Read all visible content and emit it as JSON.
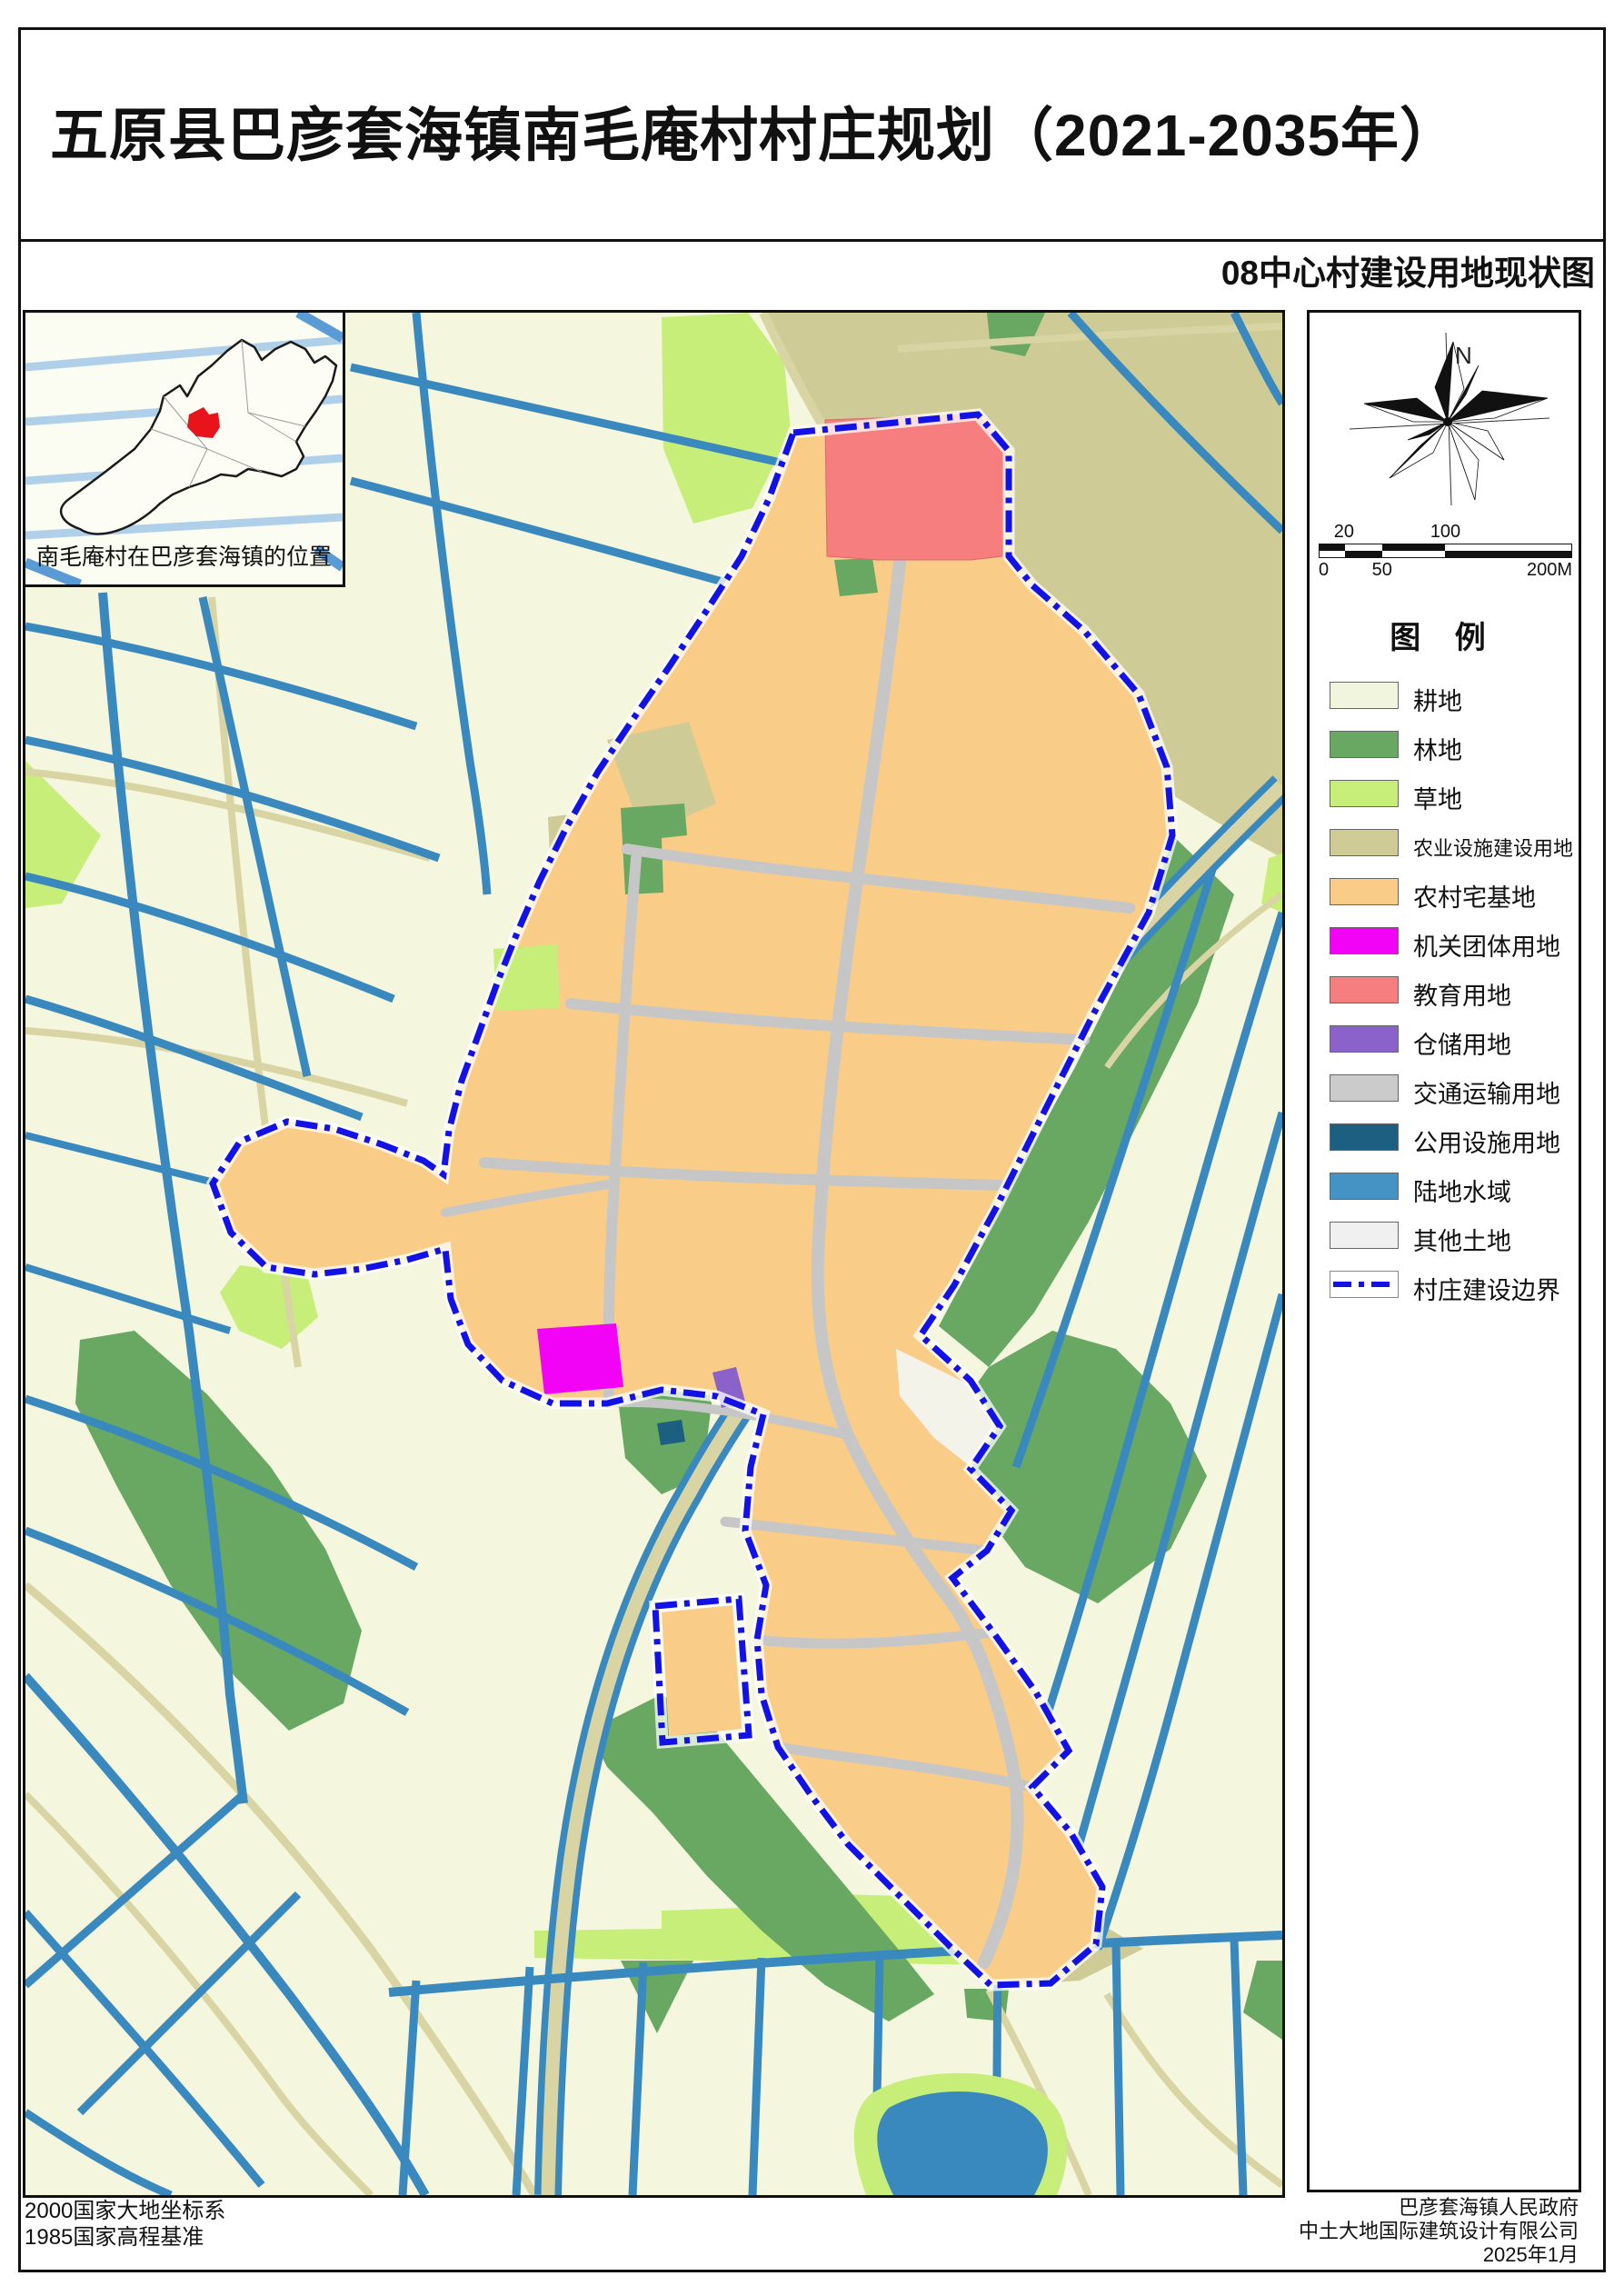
{
  "header": {
    "title": "五原县巴彦套海镇南毛庵村村庄规划（2021-2035年）",
    "subtitle": "08中心村建设用地现状图"
  },
  "inset": {
    "caption": "南毛庵村在巴彦套海镇的位置"
  },
  "compass": {
    "north_label": "N"
  },
  "scalebar": {
    "above": [
      "20",
      "100"
    ],
    "below": [
      "0",
      "50",
      "200M"
    ]
  },
  "legend": {
    "title": "图  例",
    "items": [
      {
        "label": "耕地",
        "color": "#f2f5de"
      },
      {
        "label": "林地",
        "color": "#68a862"
      },
      {
        "label": "草地",
        "color": "#c6ee79"
      },
      {
        "label": "农业设施建设用地",
        "color": "#cecb97",
        "small": true
      },
      {
        "label": "农村宅基地",
        "color": "#f9cd88"
      },
      {
        "label": "机关团体用地",
        "color": "#f303f5"
      },
      {
        "label": "教育用地",
        "color": "#f67e7e"
      },
      {
        "label": "仓储用地",
        "color": "#8a62ca"
      },
      {
        "label": "交通运输用地",
        "color": "#cbcbcb"
      },
      {
        "label": "公用设施用地",
        "color": "#1c5f80"
      },
      {
        "label": "陆地水域",
        "color": "#4493c4"
      },
      {
        "label": "其他土地",
        "color": "#f0f0f0"
      },
      {
        "label": "村庄建设边界",
        "color": "#1212e6",
        "type": "boundary"
      }
    ]
  },
  "footer": {
    "left1": "2000国家大地坐标系",
    "left2": "1985国家高程基准",
    "right1": "巴彦套海镇人民政府",
    "right2": "中土大地国际建筑设计有限公司",
    "right3": "2025年1月"
  },
  "map_colors": {
    "background_cropland": "#f4f6de",
    "water": "#3a89be",
    "field_road": "#d9d4a3",
    "village_road": "#c6c6c6",
    "boundary": "#1212e6"
  }
}
